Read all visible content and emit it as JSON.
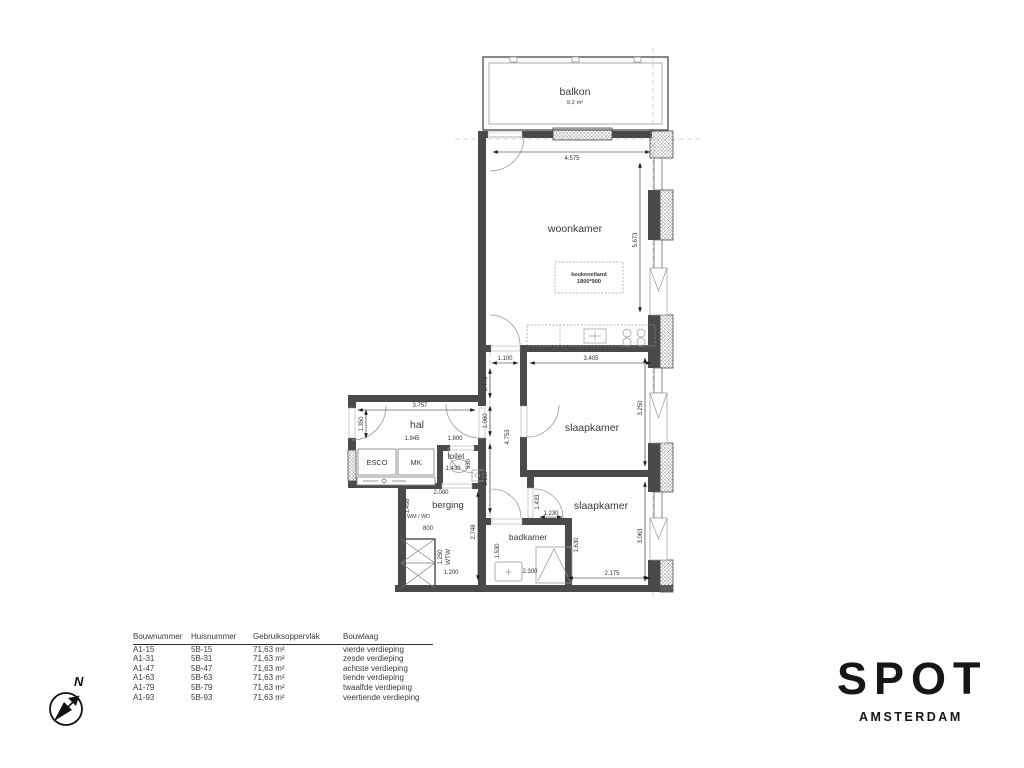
{
  "plan": {
    "balkon": {
      "label": "balkon",
      "area": "9,2 m²"
    },
    "rooms": {
      "woonkamer": "woonkamer",
      "slaapkamer1": "slaapkamer",
      "slaapkamer2": "slaapkamer",
      "hal": "hal",
      "toilet": "toilet",
      "berging": "berging",
      "badkamer": "badkamer"
    },
    "fixtures": {
      "esco": "ESCO",
      "mk": "MK",
      "wm_wd": "WM / WD",
      "wtw": "WTW",
      "keukeneiland_line1": "keukeneiland",
      "keukeneiland_line2": "1800*900"
    },
    "dims": {
      "woonkamer_breedte": "4.575",
      "woonkamer_hoogte": "5.673",
      "deur_woonkamer": "1.100",
      "slaapkamer1_breedte": "3.405",
      "gang_1": "1.475",
      "gang_2": "1.060",
      "gang_3": "2.217",
      "slaapkamer1_links": "4.753",
      "slaapkamer1_rechts": "3.250",
      "hal_breedte": "3.757",
      "hal_links": "1.350",
      "kasten": "1.945",
      "toilet_breedte": "1.800",
      "toilet_diepte": "930",
      "toilet_binnen": "1.430",
      "berging_breedte": "2.000",
      "berging_links": "1.498",
      "wm_breedte": "800",
      "wtw_hoogte": "1.250",
      "wtw_breedte": "1.200",
      "berging_rechts": "2.748",
      "slaapkamer2_nis": "1.433",
      "slaapkamer2_deur": "1.230",
      "badkamer_hoogte": "1.530",
      "badkamer_breedte": "2.300",
      "slaapkamer2_muur": "1.630",
      "slaapkamer2_rechts": "3.063",
      "slaapkamer2_breedte": "2.175"
    }
  },
  "table": {
    "headers": [
      "Bouwnummer",
      "Huisnummer",
      "Gebruiksoppervlak",
      "Bouwlaag"
    ],
    "rows": [
      [
        "A1-15",
        "5B-15",
        "71,63 m²",
        "vierde verdieping"
      ],
      [
        "A1-31",
        "5B-31",
        "71,63 m²",
        "zesde verdieping"
      ],
      [
        "A1-47",
        "5B-47",
        "71,63 m²",
        "achtste verdieping"
      ],
      [
        "A1-63",
        "5B-63",
        "71,63 m²",
        "tiende verdieping"
      ],
      [
        "A1-79",
        "5B-79",
        "71,63 m²",
        "twaalfde verdieping"
      ],
      [
        "A1-93",
        "5B-93",
        "71,63 m²",
        "veertiende verdieping"
      ]
    ]
  },
  "logo": {
    "letters": [
      "S",
      "P",
      "O",
      "T"
    ],
    "city": "AMSTERDAM"
  },
  "compass": {
    "north": "N"
  }
}
